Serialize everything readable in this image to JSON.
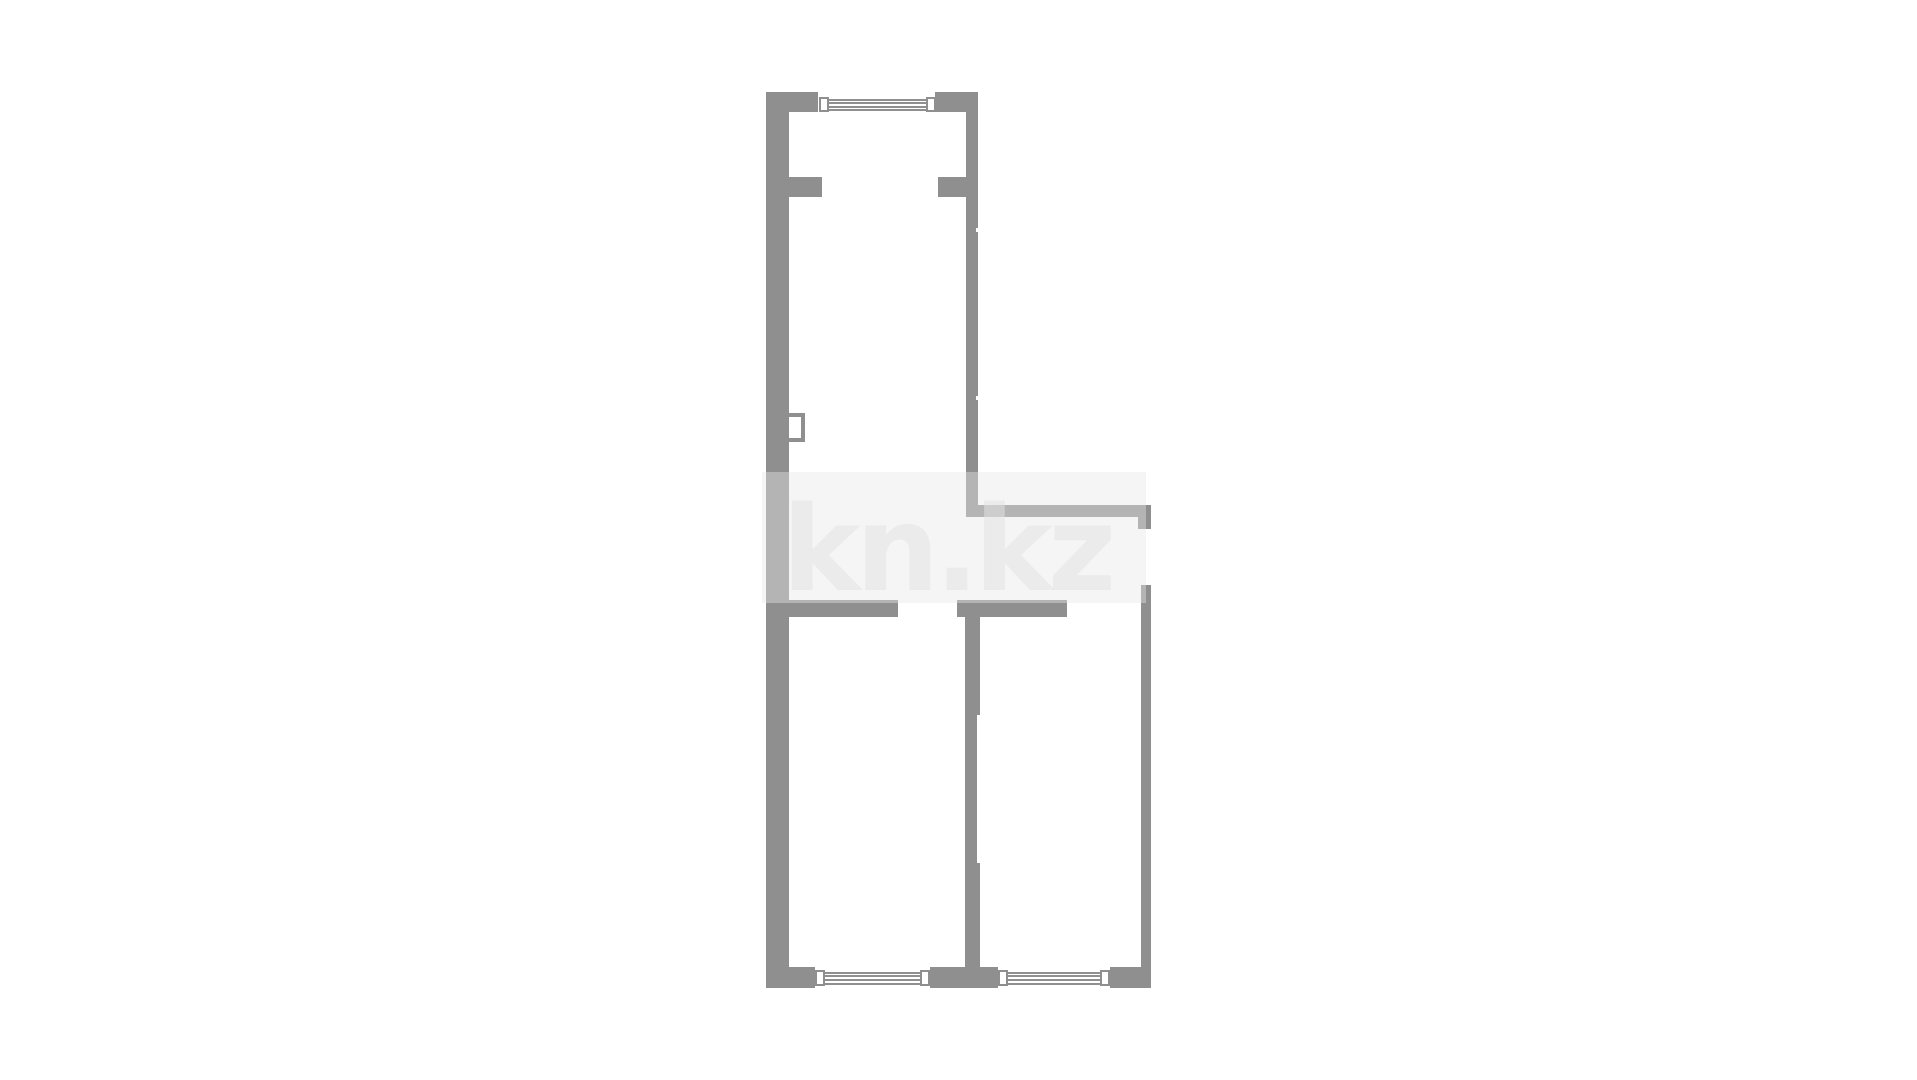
{
  "watermark": {
    "text": "kn.kz"
  },
  "colors": {
    "wall": "#8f8f8f",
    "background": "#ffffff",
    "watermark_plate": "rgba(232,232,232,0.42)",
    "watermark_text": "rgba(225,225,225,0.55)"
  },
  "plan": {
    "type": "apartment-floor-plan",
    "rooms": [
      {
        "name": "upper-hall",
        "shape": "long rectangle, top section"
      },
      {
        "name": "entry-band",
        "shape": "small area right of hall, above lower rooms"
      },
      {
        "name": "lower-left-room",
        "shape": "rectangle, bottom-left"
      },
      {
        "name": "lower-right-room",
        "shape": "rectangle, bottom-right"
      }
    ],
    "windows": [
      {
        "name": "top-window",
        "location": "top wall of upper hall"
      },
      {
        "name": "bottom-left-window",
        "location": "bottom wall of lower-left room"
      },
      {
        "name": "bottom-right-window",
        "location": "bottom wall of lower-right room"
      }
    ],
    "openings": [
      {
        "name": "hall-inner-doorway",
        "location": "between wall stubs near top of hall"
      },
      {
        "name": "hall-to-entry-opening",
        "location": "right wall of hall above lower rooms"
      },
      {
        "name": "entry-door-opening",
        "location": "right exterior wall, middle"
      },
      {
        "name": "lower-left-room-doorway",
        "location": "middle horizontal wall, left gap"
      },
      {
        "name": "lower-right-room-doorway",
        "location": "middle horizontal wall, right gap"
      }
    ],
    "fixtures": [
      {
        "name": "duct-box",
        "location": "inner side of left wall, mid-height"
      }
    ]
  }
}
